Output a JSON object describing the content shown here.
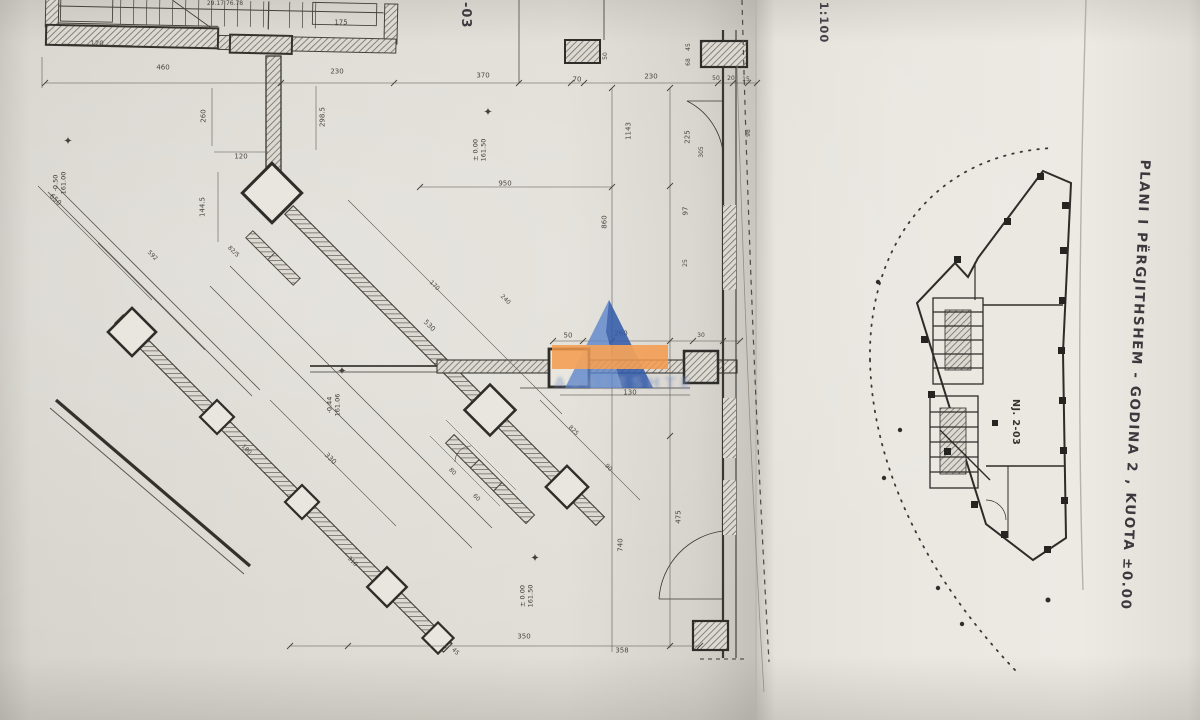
{
  "page": {
    "scale_note": "a 1:100",
    "sheet_code": "-03",
    "title_vertical": "PLANI I PËRGJITHSHEM - GODINA 2 , KUOTA ±0.00"
  },
  "key_plan": {
    "label": "NJ. 2-03"
  },
  "watermark": {
    "text": "AVALESHTE",
    "triangle_blue": "#5b85cc",
    "triangle_dark_blue": "#2d55a5",
    "band_orange": "#f49a4a",
    "text_color": "#7d94c3"
  },
  "elevation_markers": [
    {
      "value": "-0.50",
      "level": "161.00",
      "x": 68,
      "y": 141,
      "tx": 60,
      "ty": 183
    },
    {
      "value": "± 0.00",
      "level": "161.50",
      "x": 488,
      "y": 112,
      "tx": 480,
      "ty": 150
    },
    {
      "value": "-0.44",
      "level": "161.06",
      "x": 342,
      "y": 371,
      "tx": 334,
      "ty": 405
    },
    {
      "value": "± 0.00",
      "level": "161.50",
      "x": 535,
      "y": 558,
      "tx": 527,
      "ty": 596
    }
  ],
  "dimensions": [
    {
      "t": "29.17  76.78",
      "x": 225,
      "y": 4,
      "r": 0,
      "s": 6
    },
    {
      "t": "120",
      "x": 97,
      "y": 44,
      "r": 0
    },
    {
      "t": "175",
      "x": 341,
      "y": 23,
      "r": 0
    },
    {
      "t": "460",
      "x": 163,
      "y": 68,
      "r": 0
    },
    {
      "t": "230",
      "x": 337,
      "y": 72,
      "r": 0
    },
    {
      "t": "370",
      "x": 483,
      "y": 76,
      "r": 0
    },
    {
      "t": "70",
      "x": 577,
      "y": 80,
      "r": 0
    },
    {
      "t": "230",
      "x": 651,
      "y": 77,
      "r": 0
    },
    {
      "t": "50",
      "x": 716,
      "y": 79,
      "r": 0,
      "s": 6
    },
    {
      "t": "20",
      "x": 731,
      "y": 79,
      "r": 0,
      "s": 6
    },
    {
      "t": "15",
      "x": 746,
      "y": 80,
      "r": 0,
      "s": 6
    },
    {
      "t": "50",
      "x": 606,
      "y": 56,
      "r": -90,
      "s": 6
    },
    {
      "t": "45",
      "x": 689,
      "y": 47,
      "r": -90,
      "s": 6
    },
    {
      "t": "68",
      "x": 689,
      "y": 62,
      "r": -90,
      "s": 6
    },
    {
      "t": "260",
      "x": 204,
      "y": 116,
      "r": -90
    },
    {
      "t": "298.5",
      "x": 323,
      "y": 117,
      "r": -90
    },
    {
      "t": "120",
      "x": 241,
      "y": 157,
      "r": 0
    },
    {
      "t": "950",
      "x": 505,
      "y": 184,
      "r": 0
    },
    {
      "t": "1143",
      "x": 629,
      "y": 131,
      "r": -90
    },
    {
      "t": "225",
      "x": 688,
      "y": 137,
      "r": -90
    },
    {
      "t": "305",
      "x": 702,
      "y": 152,
      "r": -90,
      "s": 6
    },
    {
      "t": "98",
      "x": 749,
      "y": 133,
      "r": -90,
      "s": 6
    },
    {
      "t": "860",
      "x": 605,
      "y": 222,
      "r": -90
    },
    {
      "t": "97",
      "x": 686,
      "y": 211,
      "r": -90
    },
    {
      "t": "25",
      "x": 686,
      "y": 263,
      "r": -90,
      "s": 6
    },
    {
      "t": "650",
      "x": 55,
      "y": 200,
      "r": 45
    },
    {
      "t": "144.5",
      "x": 203,
      "y": 207,
      "r": -90
    },
    {
      "t": "592",
      "x": 152,
      "y": 256,
      "r": 45,
      "s": 6
    },
    {
      "t": "82/5",
      "x": 233,
      "y": 252,
      "r": 45,
      "s": 6
    },
    {
      "t": "170",
      "x": 434,
      "y": 286,
      "r": 45,
      "s": 6
    },
    {
      "t": "530",
      "x": 429,
      "y": 326,
      "r": 45
    },
    {
      "t": "240",
      "x": 505,
      "y": 300,
      "r": 45,
      "s": 6
    },
    {
      "t": "330",
      "x": 330,
      "y": 459,
      "r": 45
    },
    {
      "t": "180",
      "x": 246,
      "y": 450,
      "r": 45,
      "s": 6
    },
    {
      "t": "50",
      "x": 568,
      "y": 336,
      "r": 0
    },
    {
      "t": "260",
      "x": 621,
      "y": 334,
      "r": 0
    },
    {
      "t": "30",
      "x": 701,
      "y": 336,
      "r": 0,
      "s": 6
    },
    {
      "t": "130",
      "x": 630,
      "y": 393,
      "r": 0
    },
    {
      "t": "825",
      "x": 573,
      "y": 431,
      "r": 45,
      "s": 6
    },
    {
      "t": "90",
      "x": 608,
      "y": 468,
      "r": 45,
      "s": 6
    },
    {
      "t": "80",
      "x": 452,
      "y": 472,
      "r": 45,
      "s": 6
    },
    {
      "t": "60",
      "x": 476,
      "y": 498,
      "r": 45,
      "s": 6
    },
    {
      "t": "310",
      "x": 352,
      "y": 562,
      "r": 45,
      "s": 6
    },
    {
      "t": "740",
      "x": 621,
      "y": 545,
      "r": -90
    },
    {
      "t": "475",
      "x": 679,
      "y": 517,
      "r": -90
    },
    {
      "t": "350",
      "x": 524,
      "y": 637,
      "r": 0
    },
    {
      "t": "358",
      "x": 622,
      "y": 651,
      "r": 0
    },
    {
      "t": "45",
      "x": 455,
      "y": 652,
      "r": 45,
      "s": 6
    }
  ]
}
